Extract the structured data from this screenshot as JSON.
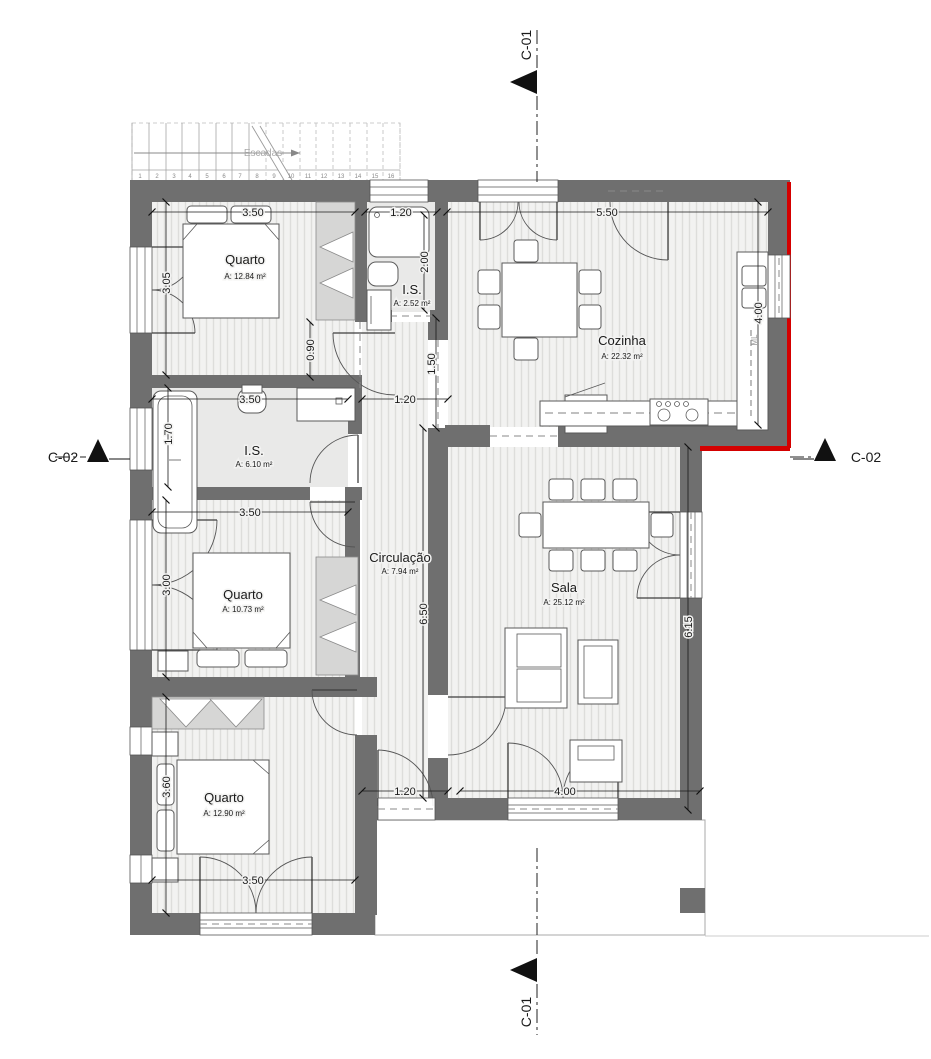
{
  "drawing": {
    "kind": "residential floor plan",
    "colors": {
      "wall": "#6f6f6f",
      "floor": "#f2f2f1",
      "accent_red": "#d40000"
    },
    "sections": {
      "c01": "C-01",
      "c02": "C-02"
    },
    "stairs": {
      "label": "Escadas",
      "numbers": [
        "1",
        "2",
        "3",
        "4",
        "5",
        "6",
        "7",
        "8",
        "9",
        "10",
        "11",
        "12",
        "13",
        "14",
        "15",
        "16"
      ]
    },
    "rooms": [
      {
        "name": "Quarto",
        "area": "A: 12.84 m²"
      },
      {
        "name": "I.S.",
        "area": "A: 2.52 m²"
      },
      {
        "name": "Cozinha",
        "area": "A: 22.32 m²"
      },
      {
        "name": "I.S.",
        "area": "A: 6.10 m²"
      },
      {
        "name": "Quarto",
        "area": "A: 10.73 m²"
      },
      {
        "name": "Circulação",
        "area": "A: 7.94 m²"
      },
      {
        "name": "Sala",
        "area": "A: 25.12 m²"
      },
      {
        "name": "Quarto",
        "area": "A: 12.90 m²"
      }
    ],
    "appliances": {
      "fridge": "F",
      "washer": "ML"
    },
    "dimensions": {
      "q1_width": "3.50",
      "is1_width": "1.20",
      "kitchen_width": "5.50",
      "q1_height": "3.05",
      "is1_depth": "2.00",
      "nook_depth": "0.90",
      "hall_top": "1.50",
      "kitchen_depth": "4.00",
      "is2_width": "3.50",
      "hall_door": "1.20",
      "is2_depth": "1.70",
      "q2_width": "3.50",
      "q2_height": "3.00",
      "circ_length": "6.50",
      "sala_depth": "6.15",
      "q3_height": "3.60",
      "terrace_door": "1.20",
      "sala_width": "4.00",
      "q3_width": "3.50"
    }
  }
}
